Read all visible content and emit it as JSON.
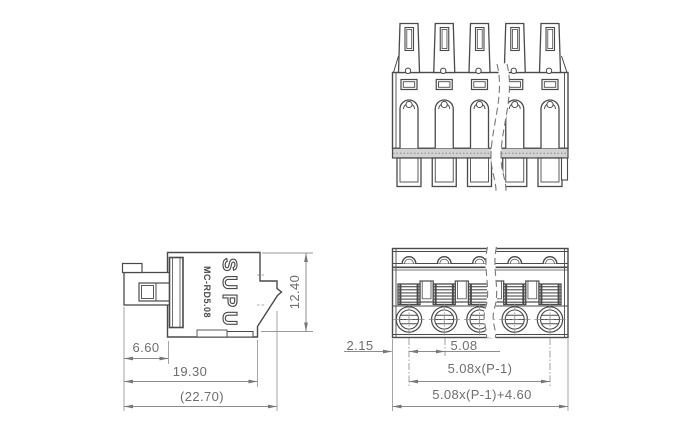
{
  "side_view": {
    "brand": "SUPU",
    "model": "MC-RD5.08",
    "dims": {
      "plug_depth": "6.60",
      "body_depth": "19.30",
      "overall_depth": "(22.70)",
      "height": "12.40"
    }
  },
  "bottom_view": {
    "dims": {
      "edge_offset": "2.15",
      "pitch": "5.08",
      "pitch_span": "5.08x(P-1)",
      "overall_width": "5.08x(P-1)+4.60"
    }
  }
}
